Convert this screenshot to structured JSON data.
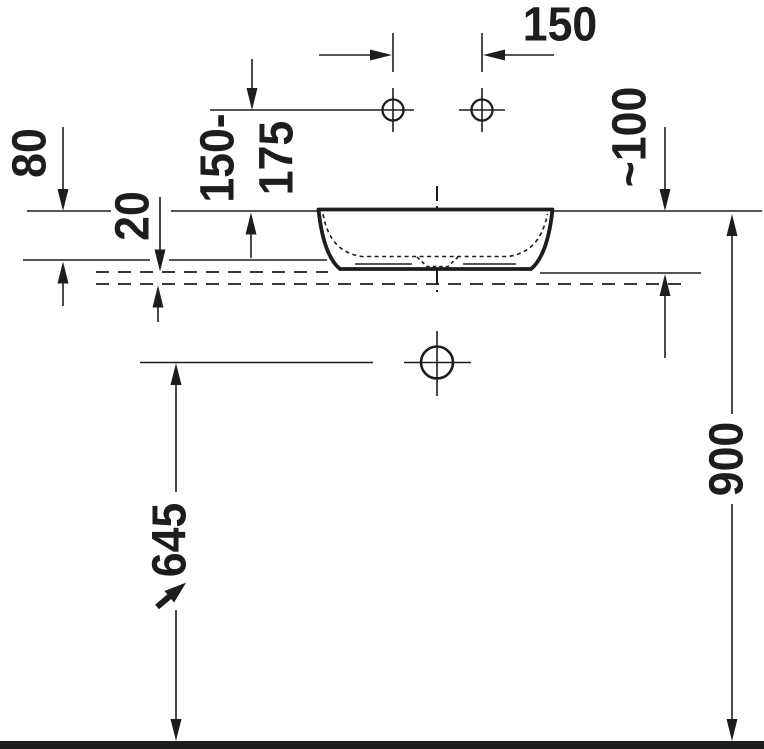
{
  "drawing": {
    "type": "technical installation drawing (washbasin, side elevation)",
    "labels": {
      "d150": "150",
      "d80": "80",
      "d20": "20",
      "d150_175": "150-\n175",
      "d100": "~100",
      "d645": "645",
      "d900": "900"
    },
    "colors": {
      "line": "#1d1d1b",
      "background": "#ffffff"
    }
  }
}
